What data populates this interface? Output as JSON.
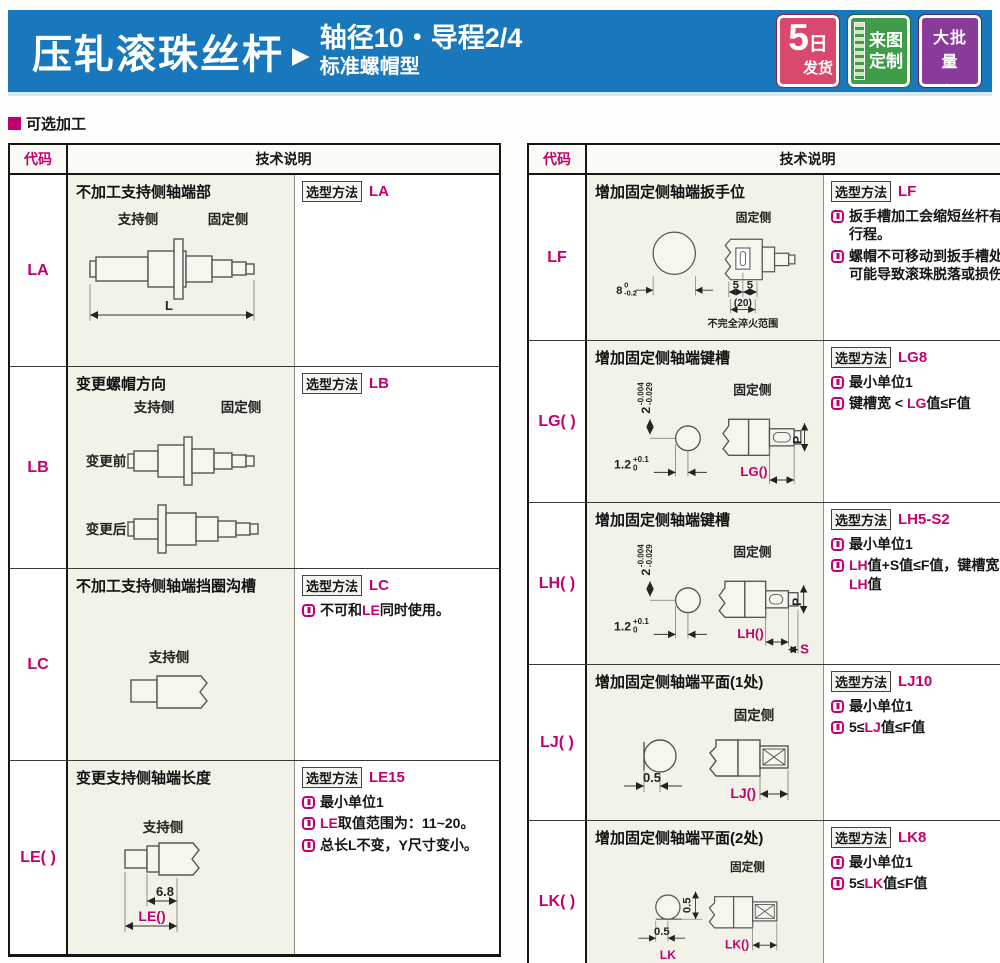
{
  "colors": {
    "banner_blue": "#1878bb",
    "magenta": "#c4006e",
    "badge_red": "#d9486d",
    "badge_green": "#3f9d49",
    "badge_purple": "#8a3a99",
    "cell_cream": "#f2f2e8"
  },
  "header": {
    "title": "压轧滚珠丝杆",
    "arrow": "▶",
    "subtitle_line1": "轴径10・导程2/4",
    "subtitle_line2": "标准螺帽型",
    "badges": [
      {
        "label": "5日发货",
        "line1": "5日",
        "big": "5",
        "unit": "日",
        "line2": "发货"
      },
      {
        "label": "来图定制",
        "line1": "来图",
        "line2": "定制",
        "icon": "ruler-icon"
      },
      {
        "label": "大批量订购",
        "line1": "大批量",
        "line2": "订购",
        "icon": "cart-icon"
      }
    ]
  },
  "section_label": "可选加工",
  "labels": {
    "code_header": "代码",
    "desc_header": "技术说明",
    "method": "选型方法"
  },
  "left_table": {
    "rows": [
      {
        "code": "LA",
        "title": "不加工支持侧轴端部",
        "method": "LA",
        "diagram": {
          "support": "支持侧",
          "fixed": "固定侧",
          "dim_l": "L"
        },
        "notes": []
      },
      {
        "code": "LB",
        "title": "变更螺帽方向",
        "method": "LB",
        "diagram": {
          "support": "支持侧",
          "fixed": "固定侧",
          "before": "变更前",
          "after": "变更后"
        },
        "notes": []
      },
      {
        "code": "LC",
        "title": "不加工支持侧轴端挡圈沟槽",
        "method": "LC",
        "diagram": {
          "support": "支持侧"
        },
        "notes": [
          [
            {
              "t": "不可和"
            },
            {
              "t": "LE",
              "m": true
            },
            {
              "t": "同时使用。"
            }
          ]
        ]
      },
      {
        "code": "LE( )",
        "title": "变更支持侧轴端长度",
        "method": "LE15",
        "diagram": {
          "support": "支持侧",
          "dim1": "6.8",
          "dim2": "LE()"
        },
        "notes": [
          [
            {
              "t": "最小单位1"
            }
          ],
          [
            {
              "t": "LE",
              "m": true
            },
            {
              "t": "取值范围为：11~20。"
            }
          ],
          [
            {
              "t": "总长L不变，Y尺寸变小。"
            }
          ]
        ]
      }
    ]
  },
  "right_table": {
    "rows": [
      {
        "code": "LF",
        "title": "增加固定侧轴端扳手位",
        "method": "LF",
        "diagram": {
          "fixed": "固定侧",
          "tol_main": "8",
          "tol_sup": "0",
          "tol_sub": "-0.2",
          "dim5a": "5",
          "dim5b": "5",
          "dim20": "(20)",
          "range_note": "不完全淬火范围"
        },
        "notes": [
          [
            {
              "t": "扳手槽加工会缩短丝杆有效行程。"
            }
          ],
          [
            {
              "t": "螺帽不可移动到扳手槽处，可能导致滚珠脱落或损伤。"
            }
          ]
        ]
      },
      {
        "code": "LG( )",
        "title": "增加固定侧轴端键槽",
        "method": "LG8",
        "diagram": {
          "fixed": "固定侧",
          "tolv_main": "2",
          "tolv_sup": "-0.004",
          "tolv_sub": "-0.029",
          "tolh_main": "1.2",
          "tolh_sup": "+0.1",
          "tolh_sub": "0",
          "dim": "LG()",
          "p": "P"
        },
        "notes": [
          [
            {
              "t": "最小单位1"
            }
          ],
          [
            {
              "t": "键槽宽 < "
            },
            {
              "t": "LG",
              "m": true
            },
            {
              "t": "值≤F值"
            }
          ]
        ]
      },
      {
        "code": "LH( )",
        "title": "增加固定侧轴端键槽",
        "method": "LH5-S2",
        "diagram": {
          "fixed": "固定侧",
          "tolv_main": "2",
          "tolv_sup": "-0.004",
          "tolv_sub": "-0.029",
          "tolh_main": "1.2",
          "tolh_sup": "+0.1",
          "tolh_sub": "0",
          "dim": "LH()",
          "p": "P",
          "s": "S"
        },
        "notes": [
          [
            {
              "t": "最小单位1"
            }
          ],
          [
            {
              "t": "LH",
              "m": true
            },
            {
              "t": "值+S值≤F值，"
            },
            {
              "t": "键槽宽 < "
            },
            {
              "t": "LH",
              "m": true
            },
            {
              "t": "值"
            }
          ]
        ]
      },
      {
        "code": "LJ( )",
        "title": "增加固定侧轴端平面(1处)",
        "method": "LJ10",
        "diagram": {
          "fixed": "固定侧",
          "dim1": "0.5",
          "dim2": "LJ()"
        },
        "notes": [
          [
            {
              "t": "最小单位1"
            }
          ],
          [
            {
              "t": "5≤"
            },
            {
              "t": "LJ",
              "m": true
            },
            {
              "t": "值≤F值"
            }
          ]
        ]
      },
      {
        "code": "LK( )",
        "title": "增加固定侧轴端平面(2处)",
        "method": "LK8",
        "diagram": {
          "fixed": "固定侧",
          "dimv": "0.5",
          "dimh": "0.5",
          "lk": "LK",
          "pos": "位置90°",
          "dim2": "LK()"
        },
        "notes": [
          [
            {
              "t": "最小单位1"
            }
          ],
          [
            {
              "t": "5≤"
            },
            {
              "t": "LK",
              "m": true
            },
            {
              "t": "值≤F值"
            }
          ]
        ]
      }
    ]
  }
}
